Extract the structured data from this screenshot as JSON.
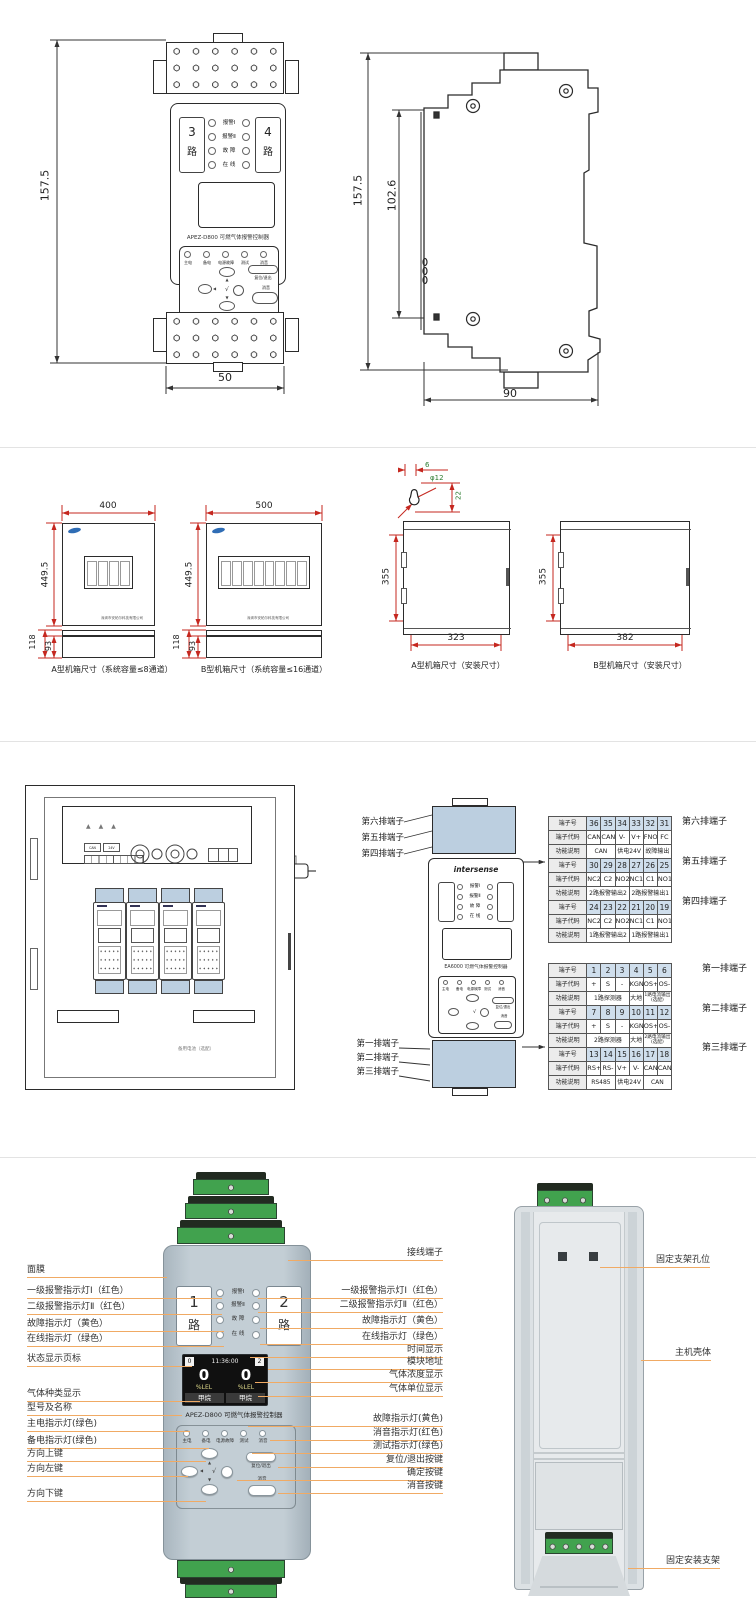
{
  "colors": {
    "callout_line": "#F0AA64",
    "dim_line_red": "#D93025",
    "keyhole_dim_green": "#2E7D32",
    "terminal_green": "#41A24E",
    "table_header_blue": "#CFDEEC",
    "device_body_gray_blue": "#B7C3CB",
    "screen_black": "#111111"
  },
  "s1": {
    "front": {
      "dim_h": "157.5",
      "dim_w": "50",
      "ch_l_num": "3",
      "ch_r_num": "4",
      "lu": "路",
      "leds": [
        "报警Ⅰ",
        "报警Ⅱ",
        "故 障",
        "在 线"
      ],
      "model": "APEZ-D800 可燃气体报警控制器",
      "status": [
        "主电",
        "备电",
        "电源故障",
        "测试",
        "消音"
      ],
      "reset": "复位/退出",
      "mute": "消音",
      "nav": {
        "up": "▲",
        "down": "▼",
        "left": "◀",
        "ok": "√"
      }
    },
    "side": {
      "dim_h": "157.5",
      "dim_m": "102.6",
      "dim_w": "90"
    }
  },
  "s2": {
    "cabA": {
      "dim_w": "400",
      "dim_h": "449.5",
      "dim_d1": "118",
      "dim_d2": "93",
      "caption": "A型机箱尺寸（系统容量≤8通道）",
      "company": "深圳市安帕尔科技有限公司"
    },
    "cabB": {
      "dim_w": "500",
      "dim_h": "449.5",
      "dim_d1": "118",
      "dim_d2": "93",
      "caption": "B型机箱尺寸（系统容量≤16通道）",
      "company": "深圳市安帕尔科技有限公司"
    },
    "keyhole": {
      "d1": "6",
      "d2": "φ12",
      "d3": "22"
    },
    "mntA": {
      "dim_h": "355",
      "dim_w": "323",
      "caption": "A型机箱尺寸（安装尺寸）"
    },
    "mntB": {
      "dim_h": "355",
      "dim_w": "382",
      "caption": "B型机箱尺寸（安装尺寸）"
    }
  },
  "s3": {
    "rows_top": [
      "第六排端子",
      "第五排端子",
      "第四排端子"
    ],
    "rows_bottom": [
      "第一排端子",
      "第二排端子",
      "第三排端子"
    ],
    "labels": {
      "can": "CAN",
      "v24": "24V",
      "battery": "备用电池（选配）"
    },
    "module": {
      "brand": "intersense",
      "leds": [
        "报警Ⅰ",
        "报警Ⅱ",
        "故 障",
        "在 线"
      ],
      "model": "EA6000 可燃气体报警控制器",
      "status": [
        "主电",
        "备电",
        "电源故障",
        "测试",
        "消音"
      ],
      "reset": "复位/退出",
      "mute": "消音",
      "nav": {
        "up": "▲",
        "down": "▼",
        "left": "◀",
        "ok": "√"
      }
    },
    "t6": {
      "r1": [
        "端子号",
        "36",
        "35",
        "34",
        "33",
        "32",
        "31"
      ],
      "r2": [
        "端子代码",
        "CAN-",
        "CAN+",
        "V-",
        "V+",
        "FNO",
        "FC"
      ],
      "r3": [
        "功能说明",
        "CAN",
        "供电24V",
        "故障输出"
      ]
    },
    "t5": {
      "r1": [
        "端子号",
        "30",
        "29",
        "28",
        "27",
        "26",
        "25"
      ],
      "r2": [
        "端子代码",
        "NC2",
        "C2",
        "NO2",
        "NC1",
        "C1",
        "NO1"
      ],
      "r3": [
        "功能说明",
        "2路报警输出2",
        "2路报警输出1"
      ]
    },
    "t4": {
      "r1": [
        "端子号",
        "24",
        "23",
        "22",
        "21",
        "20",
        "19"
      ],
      "r2": [
        "端子代码",
        "NC2",
        "C2",
        "NO2",
        "NC1",
        "C1",
        "NO1"
      ],
      "r3": [
        "功能说明",
        "1路报警输出2",
        "1路报警输出1"
      ]
    },
    "t1": {
      "r1": [
        "端子号",
        "1",
        "2",
        "3",
        "4",
        "5",
        "6"
      ],
      "r2": [
        "端子代码",
        "+",
        "S",
        "-",
        "KGND",
        "OS+",
        "OS-"
      ],
      "r3": [
        "功能说明",
        "1路探测器",
        "大地",
        "1路电流输出(选配)"
      ]
    },
    "t2": {
      "r1": [
        "端子号",
        "7",
        "8",
        "9",
        "10",
        "11",
        "12"
      ],
      "r2": [
        "端子代码",
        "+",
        "S",
        "-",
        "KGND",
        "OS+",
        "OS-"
      ],
      "r3": [
        "功能说明",
        "2路探测器",
        "大地",
        "2路电流输出(选配)"
      ]
    },
    "t3": {
      "r1": [
        "端子号",
        "13",
        "14",
        "15",
        "16",
        "17",
        "18"
      ],
      "r2": [
        "端子代码",
        "RS+",
        "RS-",
        "V+",
        "V-",
        "CAN+",
        "CAN-"
      ],
      "r3": [
        "功能说明",
        "RS485",
        "供电24V",
        "CAN"
      ]
    }
  },
  "s4": {
    "left_labels": [
      "面膜",
      "一级报警指示灯Ⅰ（红色）",
      "二级报警指示灯Ⅱ（红色）",
      "故障指示灯（黄色）",
      "在线指示灯（绿色）",
      "状态显示页标",
      "气体种类显示",
      "型号及名称",
      "主电指示灯(绿色)",
      "备电指示灯(绿色)",
      "方向上键",
      "方向左键",
      "方向下键"
    ],
    "right_labels": [
      "接线端子",
      "一级报警指示灯Ⅰ（红色）",
      "二级报警指示灯Ⅱ（红色）",
      "故障指示灯（黄色）",
      "在线指示灯（绿色）",
      "时间显示",
      "模块地址",
      "气体浓度显示",
      "气体单位显示",
      "故障指示灯(黄色)",
      "消音指示灯(红色)",
      "测试指示灯(绿色)",
      "复位/退出按键",
      "确定按键",
      "消音按键"
    ],
    "rear_labels": [
      "固定支架孔位",
      "主机壳体",
      "固定安装支架"
    ],
    "device": {
      "ch_l": "1",
      "ch_r": "2",
      "lu": "路",
      "leds": [
        "报警Ⅰ",
        "报警Ⅱ",
        "故 障",
        "在 线"
      ],
      "model": "APEZ-D800 可燃气体报警控制器",
      "status": [
        "主电",
        "备电",
        "电源故障",
        "测试",
        "消音"
      ],
      "reset": "复位/退出",
      "mute": "消音",
      "nav": {
        "up": "▲",
        "down": "▼",
        "left": "◀",
        "ok": "√"
      },
      "screen": {
        "page_l": "0",
        "time": "11:36:00",
        "page_r": "2",
        "v1": "0",
        "v2": "0",
        "u1": "%LEL",
        "u2": "%LEL",
        "g1": "甲烷",
        "g2": "甲烷"
      }
    }
  }
}
